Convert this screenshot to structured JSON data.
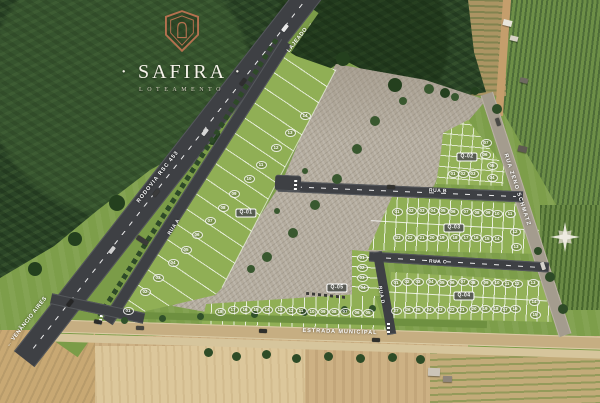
{
  "title": "Safira Loteamento — Masterplan",
  "logo": {
    "title": "· SAFIRA ·",
    "subtitle": "LOTEAMENTO"
  },
  "roads": {
    "rodovia": "RODOVIA RSC 453",
    "rua_a": "RUA A",
    "rua_b": "RUA B",
    "rua_c": "RUA C",
    "rua_d": "RUA D",
    "rua_zeno": "RUA ZENO SCHMATZ",
    "estrada": "ESTRADA MUNICIPAL"
  },
  "directions": {
    "southwest": "← VENÂNCIO AIRES",
    "northeast": "LAJEADO →"
  },
  "quadrants": [
    {
      "id": "q01",
      "label": "Q-01",
      "lots": [
        "01",
        "02",
        "03",
        "04",
        "05",
        "06",
        "07",
        "08",
        "09",
        "10",
        "11",
        "12",
        "13",
        "14"
      ]
    },
    {
      "id": "q02",
      "label": "Q-02",
      "lots": [
        "01",
        "02",
        "03",
        "04",
        "05",
        "06",
        "07"
      ]
    },
    {
      "id": "q03",
      "label": "Q-03",
      "lots": [
        "01",
        "02",
        "03",
        "04",
        "05",
        "06",
        "07",
        "08",
        "09",
        "10",
        "11",
        "12",
        "13",
        "14",
        "15",
        "16",
        "17",
        "18",
        "19",
        "20",
        "21",
        "22",
        "23"
      ]
    },
    {
      "id": "q04",
      "label": "Q-04",
      "lots": [
        "01",
        "02",
        "03",
        "04",
        "05",
        "06",
        "07",
        "08",
        "09",
        "10",
        "11",
        "12",
        "13",
        "14",
        "15",
        "16",
        "17",
        "18",
        "19",
        "20",
        "21",
        "22",
        "23",
        "24",
        "25",
        "26",
        "27"
      ]
    },
    {
      "id": "q05",
      "label": "Q-05",
      "lots": [
        "01",
        "02",
        "03",
        "04",
        "05",
        "06",
        "07",
        "08",
        "09",
        "10",
        "11",
        "12",
        "13",
        "14",
        "15",
        "16",
        "17",
        "18"
      ]
    }
  ],
  "compass": {
    "icon": "compass-rose"
  },
  "colors": {
    "brand_copper": "#B5714F",
    "asphalt": "#3E4044",
    "grass": "#7D9E4A",
    "gravel": "#B4AC9E",
    "dirt_road": "#C6AE82"
  }
}
